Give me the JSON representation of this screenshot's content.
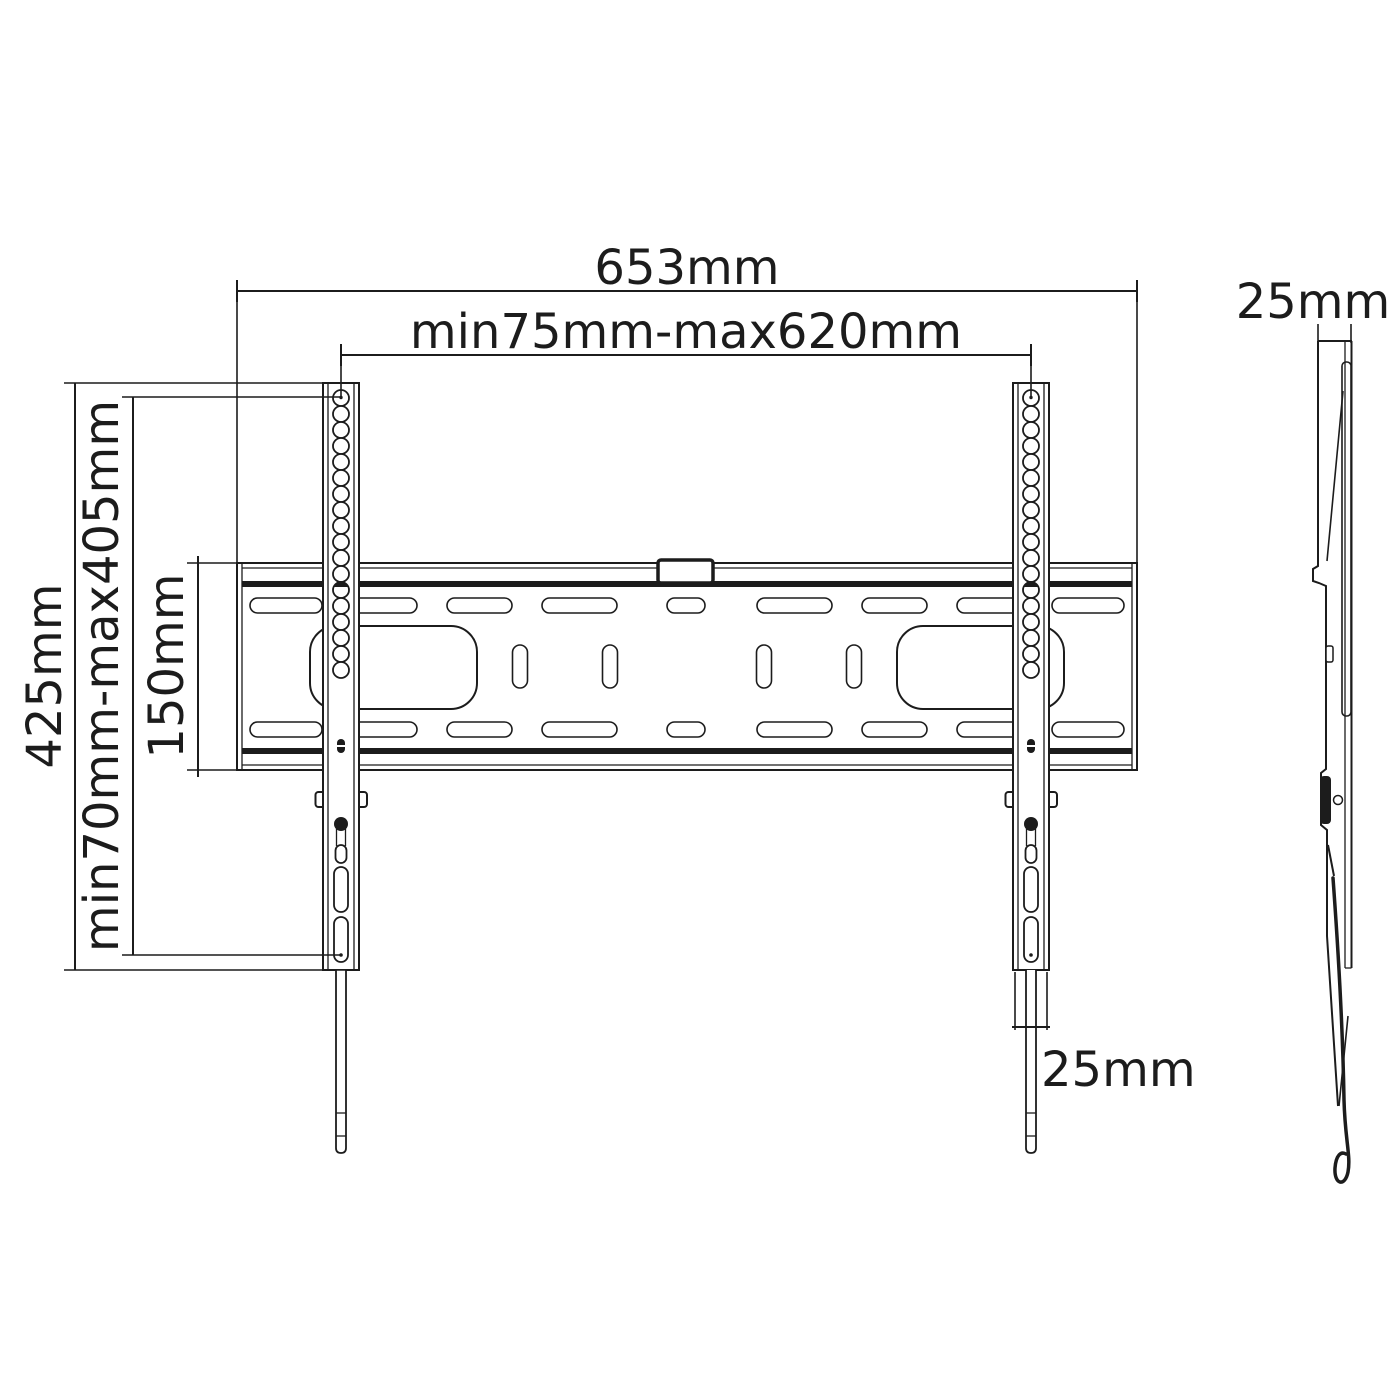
{
  "diagram": {
    "type": "technical-dimension-drawing",
    "views": {
      "front": "tv-wall-mount-front-view",
      "side": "tv-wall-mount-side-profile"
    },
    "labels": {
      "overall_width": "653mm",
      "width_range": "min75mm-max620mm",
      "overall_height": "425mm",
      "height_range": "min70mm-max405mm",
      "plate_height": "150mm",
      "depth": "25mm",
      "rail_width": "25mm"
    },
    "colors": {
      "line": "#1c1c1c",
      "background": "#ffffff"
    }
  }
}
